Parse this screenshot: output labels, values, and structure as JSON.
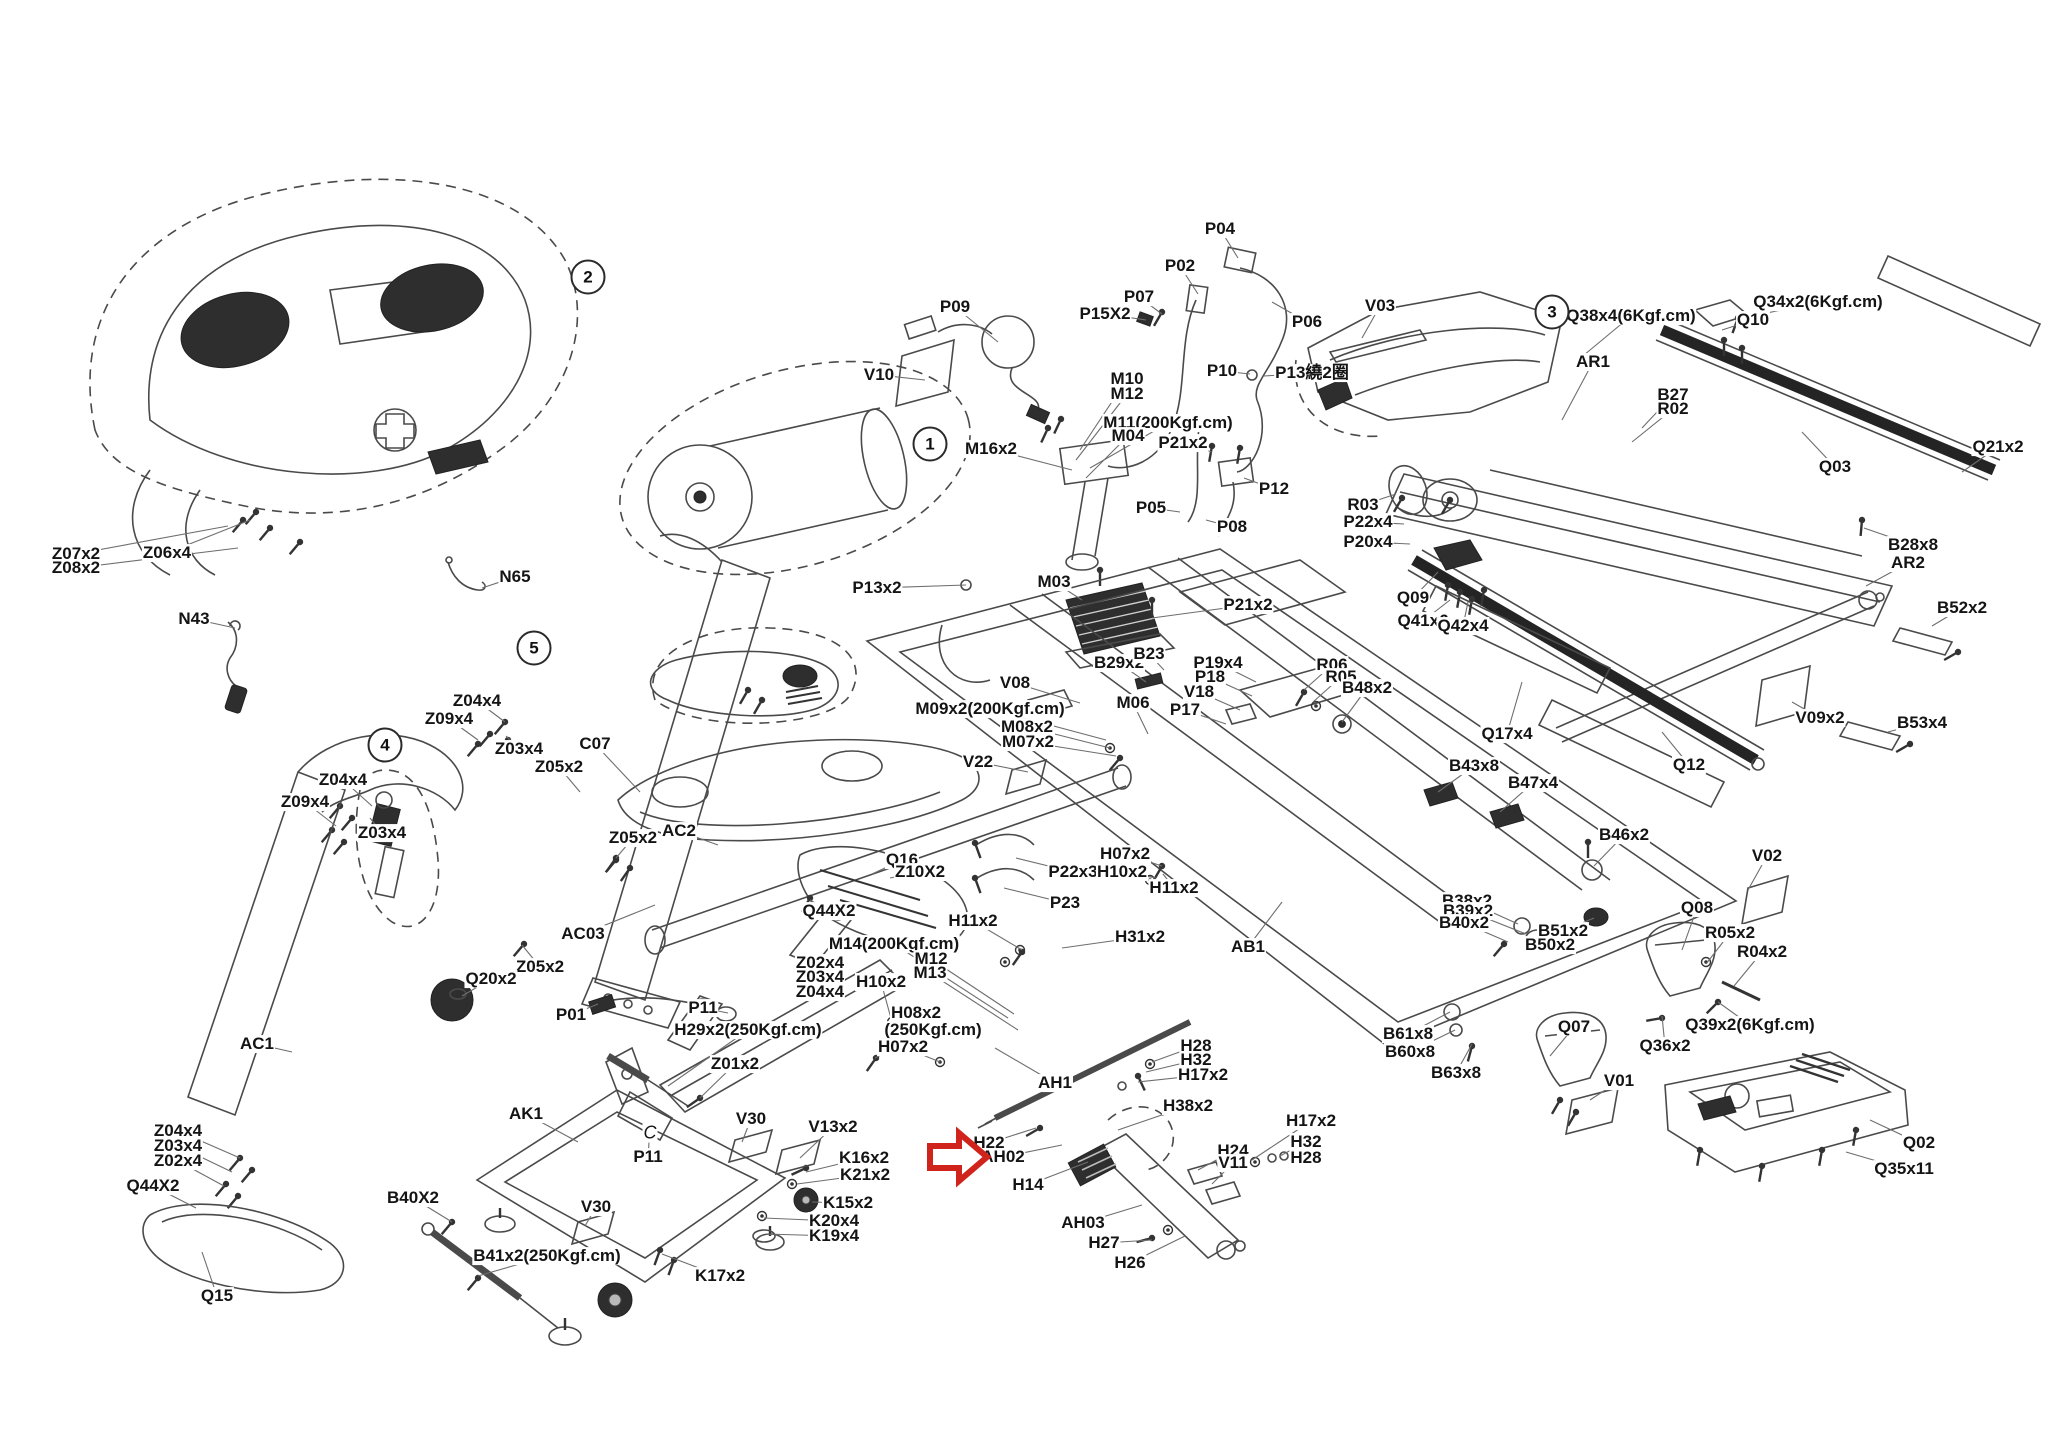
{
  "diagram": {
    "type": "exploded-parts-diagram",
    "subject": "treadmill assembly",
    "accent_color": "#cf231c",
    "callouts": [
      {
        "num": "1",
        "x": 930,
        "y": 444
      },
      {
        "num": "2",
        "x": 588,
        "y": 277
      },
      {
        "num": "3",
        "x": 1552,
        "y": 312
      },
      {
        "num": "4",
        "x": 385,
        "y": 745
      },
      {
        "num": "5",
        "x": 534,
        "y": 648
      }
    ],
    "arrow": {
      "x": 938,
      "y": 1138,
      "points_to": "AH02",
      "color": "#cf231c"
    },
    "labels": [
      {
        "t": "Z07x2",
        "x": 76,
        "y": 554,
        "tx": 228,
        "ty": 526
      },
      {
        "t": "Z08x2",
        "x": 76,
        "y": 568,
        "tx": 238,
        "ty": 548
      },
      {
        "t": "Z06x4",
        "x": 167,
        "y": 553,
        "tx": 250,
        "ty": 520
      },
      {
        "t": "N43",
        "x": 194,
        "y": 619,
        "tx": 235,
        "ty": 628
      },
      {
        "t": "N65",
        "x": 515,
        "y": 577,
        "tx": 482,
        "ty": 588
      },
      {
        "t": "Z04x4",
        "x": 477,
        "y": 701,
        "tx": 505,
        "ty": 722
      },
      {
        "t": "Z09x4",
        "x": 449,
        "y": 719,
        "tx": 478,
        "ty": 740
      },
      {
        "t": "Z03x4",
        "x": 519,
        "y": 749,
        "tx": 506,
        "ty": 736
      },
      {
        "t": "C07",
        "x": 595,
        "y": 744,
        "tx": 640,
        "ty": 792
      },
      {
        "t": "Z05x2",
        "x": 559,
        "y": 767,
        "tx": 580,
        "ty": 792
      },
      {
        "t": "Z04x4",
        "x": 343,
        "y": 780,
        "tx": 372,
        "ty": 806
      },
      {
        "t": "Z09x4",
        "x": 305,
        "y": 802,
        "tx": 336,
        "ty": 826
      },
      {
        "t": "Z03x4",
        "x": 382,
        "y": 833,
        "tx": 370,
        "ty": 818
      },
      {
        "t": "AC2",
        "x": 679,
        "y": 831,
        "tx": 718,
        "ty": 845
      },
      {
        "t": "Z05x2",
        "x": 633,
        "y": 838,
        "tx": 616,
        "ty": 858
      },
      {
        "t": "AC03",
        "x": 583,
        "y": 934,
        "tx": 655,
        "ty": 905
      },
      {
        "t": "Z05x2",
        "x": 540,
        "y": 967,
        "tx": 522,
        "ty": 945
      },
      {
        "t": "Q20x2",
        "x": 491,
        "y": 979,
        "tx": 462,
        "ty": 996
      },
      {
        "t": "P01",
        "x": 571,
        "y": 1015,
        "tx": 598,
        "ty": 1004
      },
      {
        "t": "P11",
        "x": 703,
        "y": 1008,
        "tx": 728,
        "ty": 1013
      },
      {
        "t": "H29x2(250Kgf.cm)",
        "x": 748,
        "y": 1030,
        "tx": 668,
        "ty": 1086
      },
      {
        "t": "Z01x2",
        "x": 735,
        "y": 1064,
        "tx": 700,
        "ty": 1098
      },
      {
        "t": "AK1",
        "x": 526,
        "y": 1114,
        "tx": 578,
        "ty": 1142
      },
      {
        "t": "AC1",
        "x": 257,
        "y": 1044,
        "tx": 292,
        "ty": 1052
      },
      {
        "t": "Z04x4",
        "x": 178,
        "y": 1131,
        "tx": 240,
        "ty": 1158
      },
      {
        "t": "Z03x4",
        "x": 178,
        "y": 1146,
        "tx": 232,
        "ty": 1172
      },
      {
        "t": "Z02x4",
        "x": 178,
        "y": 1161,
        "tx": 224,
        "ty": 1186
      },
      {
        "t": "Q44X2",
        "x": 153,
        "y": 1186,
        "tx": 196,
        "ty": 1208
      },
      {
        "t": "Q15",
        "x": 217,
        "y": 1296,
        "tx": 202,
        "ty": 1252
      },
      {
        "t": "B40X2",
        "x": 413,
        "y": 1198,
        "tx": 452,
        "ty": 1222
      },
      {
        "t": "B41x2(250Kgf.cm)",
        "x": 547,
        "y": 1256,
        "tx": 478,
        "ty": 1276
      },
      {
        "t": "P11",
        "x": 648,
        "y": 1157,
        "tx": 650,
        "ty": 1128
      },
      {
        "t": "C",
        "x": 650,
        "y": 1133,
        "cls": "italic"
      },
      {
        "t": "V30",
        "x": 751,
        "y": 1119,
        "tx": 742,
        "ty": 1142
      },
      {
        "t": "V13x2",
        "x": 833,
        "y": 1127,
        "tx": 800,
        "ty": 1158
      },
      {
        "t": "K16x2",
        "x": 864,
        "y": 1158,
        "tx": 806,
        "ty": 1172
      },
      {
        "t": "K21x2",
        "x": 865,
        "y": 1175,
        "tx": 797,
        "ty": 1184
      },
      {
        "t": "K15x2",
        "x": 848,
        "y": 1203,
        "tx": 812,
        "ty": 1202
      },
      {
        "t": "K20x4",
        "x": 834,
        "y": 1221,
        "tx": 764,
        "ty": 1218
      },
      {
        "t": "K19x4",
        "x": 834,
        "y": 1236,
        "tx": 766,
        "ty": 1234
      },
      {
        "t": "K17x2",
        "x": 720,
        "y": 1276,
        "tx": 662,
        "ty": 1254
      },
      {
        "t": "V30",
        "x": 596,
        "y": 1207,
        "tx": 585,
        "ty": 1226
      },
      {
        "t": "Q16",
        "x": 902,
        "y": 860,
        "tx": 872,
        "ty": 874
      },
      {
        "t": "Z10X2",
        "x": 920,
        "y": 872,
        "tx": 890,
        "ty": 878
      },
      {
        "t": "Q44X2",
        "x": 829,
        "y": 911,
        "tx": 810,
        "ty": 900
      },
      {
        "t": "M14(200Kgf.cm)",
        "x": 894,
        "y": 944,
        "tx": 1008,
        "ty": 1018
      },
      {
        "t": "M12",
        "x": 931,
        "y": 959,
        "tx": 1014,
        "ty": 1014
      },
      {
        "t": "M13",
        "x": 930,
        "y": 973,
        "tx": 1018,
        "ty": 1030
      },
      {
        "t": "Z02x4",
        "x": 820,
        "y": 963
      },
      {
        "t": "Z03x4",
        "x": 820,
        "y": 977
      },
      {
        "t": "Z04x4",
        "x": 820,
        "y": 992
      },
      {
        "t": "H10x2",
        "x": 881,
        "y": 982,
        "tx": 892,
        "ty": 1022
      },
      {
        "t": "H08x2",
        "x": 916,
        "y": 1013
      },
      {
        "t": "(250Kgf.cm)",
        "x": 933,
        "y": 1030,
        "tx": 875,
        "ty": 1058
      },
      {
        "t": "H07x2",
        "x": 903,
        "y": 1047,
        "tx": 940,
        "ty": 1062
      },
      {
        "t": "AH1",
        "x": 1055,
        "y": 1083,
        "tx": 995,
        "ty": 1048
      },
      {
        "t": "H11x2",
        "x": 973,
        "y": 921,
        "tx": 1022,
        "ty": 950
      },
      {
        "t": "H31x2",
        "x": 1140,
        "y": 937,
        "tx": 1062,
        "ty": 948
      },
      {
        "t": "AB1",
        "x": 1248,
        "y": 947,
        "tx": 1282,
        "ty": 902
      },
      {
        "t": "P22x3",
        "x": 1073,
        "y": 872,
        "tx": 1016,
        "ty": 858
      },
      {
        "t": "P23",
        "x": 1065,
        "y": 903,
        "tx": 1004,
        "ty": 888
      },
      {
        "t": "H07x2",
        "x": 1125,
        "y": 854,
        "tx": 1162,
        "ty": 866
      },
      {
        "t": "H10x2",
        "x": 1122,
        "y": 872,
        "tx": 1156,
        "ty": 878
      },
      {
        "t": "H11x2",
        "x": 1174,
        "y": 888,
        "tx": 1163,
        "ty": 874
      },
      {
        "t": "H28",
        "x": 1196,
        "y": 1046,
        "tx": 1152,
        "ty": 1062
      },
      {
        "t": "H32",
        "x": 1196,
        "y": 1060,
        "tx": 1146,
        "ty": 1072
      },
      {
        "t": "H17x2",
        "x": 1203,
        "y": 1075,
        "tx": 1138,
        "ty": 1082
      },
      {
        "t": "H38x2",
        "x": 1188,
        "y": 1106,
        "tx": 1118,
        "ty": 1130
      },
      {
        "t": "H22",
        "x": 989,
        "y": 1143,
        "tx": 1036,
        "ty": 1128
      },
      {
        "t": "AH02",
        "x": 1003,
        "y": 1157,
        "tx": 1062,
        "ty": 1145
      },
      {
        "t": "H14",
        "x": 1028,
        "y": 1185,
        "tx": 1088,
        "ty": 1162
      },
      {
        "t": "AH03",
        "x": 1083,
        "y": 1223,
        "tx": 1142,
        "ty": 1205
      },
      {
        "t": "H27",
        "x": 1104,
        "y": 1243,
        "tx": 1152,
        "ty": 1240
      },
      {
        "t": "H26",
        "x": 1130,
        "y": 1263,
        "tx": 1185,
        "ty": 1236
      },
      {
        "t": "H24",
        "x": 1233,
        "y": 1151,
        "tx": 1198,
        "ty": 1170
      },
      {
        "t": "V11",
        "x": 1233,
        "y": 1163,
        "tx": 1212,
        "ty": 1184
      },
      {
        "t": "H17x2",
        "x": 1311,
        "y": 1121,
        "tx": 1252,
        "ty": 1160
      },
      {
        "t": "H32",
        "x": 1306,
        "y": 1142,
        "tx": 1280,
        "ty": 1156
      },
      {
        "t": "H28",
        "x": 1306,
        "y": 1158,
        "tx": 1292,
        "ty": 1160
      },
      {
        "t": "P09",
        "x": 955,
        "y": 307,
        "tx": 998,
        "ty": 342
      },
      {
        "t": "V10",
        "x": 879,
        "y": 375,
        "tx": 925,
        "ty": 380
      },
      {
        "t": "M16x2",
        "x": 991,
        "y": 449,
        "tx": 1072,
        "ty": 470
      },
      {
        "t": "P04",
        "x": 1220,
        "y": 229,
        "tx": 1238,
        "ty": 258
      },
      {
        "t": "P02",
        "x": 1180,
        "y": 266,
        "tx": 1198,
        "ty": 294
      },
      {
        "t": "P07",
        "x": 1139,
        "y": 297,
        "tx": 1162,
        "ty": 314
      },
      {
        "t": "P15X2",
        "x": 1105,
        "y": 314,
        "tx": 1146,
        "ty": 320
      },
      {
        "t": "P06",
        "x": 1307,
        "y": 322,
        "tx": 1272,
        "ty": 302
      },
      {
        "t": "V03",
        "x": 1380,
        "y": 306,
        "tx": 1362,
        "ty": 338
      },
      {
        "t": "P10",
        "x": 1222,
        "y": 371,
        "tx": 1250,
        "ty": 374
      },
      {
        "t": "P13繞2圈",
        "x": 1312,
        "y": 373,
        "tx": 1264,
        "ty": 376
      },
      {
        "t": "M10",
        "x": 1127,
        "y": 379,
        "tx": 1080,
        "ty": 450
      },
      {
        "t": "M12",
        "x": 1127,
        "y": 394,
        "tx": 1076,
        "ty": 460
      },
      {
        "t": "M11(200Kgf.cm)",
        "x": 1168,
        "y": 423,
        "tx": 1090,
        "ty": 468
      },
      {
        "t": "M04",
        "x": 1128,
        "y": 436,
        "tx": 1086,
        "ty": 478
      },
      {
        "t": "P21x2",
        "x": 1183,
        "y": 443,
        "tx": 1212,
        "ty": 452
      },
      {
        "t": "P12",
        "x": 1274,
        "y": 489,
        "tx": 1244,
        "ty": 478
      },
      {
        "t": "P05",
        "x": 1151,
        "y": 508,
        "tx": 1180,
        "ty": 512
      },
      {
        "t": "P08",
        "x": 1232,
        "y": 527,
        "tx": 1206,
        "ty": 520
      },
      {
        "t": "P13x2",
        "x": 877,
        "y": 588,
        "tx": 966,
        "ty": 585
      },
      {
        "t": "M03",
        "x": 1054,
        "y": 582,
        "tx": 1082,
        "ty": 600
      },
      {
        "t": "P21x2",
        "x": 1248,
        "y": 605,
        "tx": 1152,
        "ty": 618
      },
      {
        "t": "B29x2",
        "x": 1119,
        "y": 663,
        "tx": 1146,
        "ty": 682
      },
      {
        "t": "B23",
        "x": 1149,
        "y": 654,
        "tx": 1164,
        "ty": 670
      },
      {
        "t": "P19x4",
        "x": 1218,
        "y": 663,
        "tx": 1256,
        "ty": 682
      },
      {
        "t": "P18",
        "x": 1210,
        "y": 677,
        "tx": 1252,
        "ty": 696
      },
      {
        "t": "V18",
        "x": 1199,
        "y": 692,
        "tx": 1240,
        "ty": 710
      },
      {
        "t": "P17",
        "x": 1185,
        "y": 710,
        "tx": 1226,
        "ty": 724
      },
      {
        "t": "V08",
        "x": 1015,
        "y": 683,
        "tx": 1080,
        "ty": 703
      },
      {
        "t": "M09x2(200Kgf.cm)",
        "x": 990,
        "y": 709,
        "tx": 1106,
        "ty": 740
      },
      {
        "t": "M06",
        "x": 1133,
        "y": 703,
        "tx": 1148,
        "ty": 734
      },
      {
        "t": "M08x2",
        "x": 1027,
        "y": 727,
        "tx": 1110,
        "ty": 748
      },
      {
        "t": "M07x2",
        "x": 1028,
        "y": 742,
        "tx": 1116,
        "ty": 756
      },
      {
        "t": "V22",
        "x": 978,
        "y": 762,
        "tx": 1028,
        "ty": 772
      },
      {
        "t": "R06",
        "x": 1332,
        "y": 665,
        "tx": 1304,
        "ty": 690
      },
      {
        "t": "R05",
        "x": 1341,
        "y": 677,
        "tx": 1313,
        "ty": 702
      },
      {
        "t": "B48x2",
        "x": 1367,
        "y": 688,
        "tx": 1342,
        "ty": 722
      },
      {
        "t": "Q38x4(6Kgf.cm)",
        "x": 1631,
        "y": 316,
        "tx": 1578,
        "ty": 360
      },
      {
        "t": "AR1",
        "x": 1593,
        "y": 362,
        "tx": 1562,
        "ty": 420
      },
      {
        "t": "Q34x2(6Kgf.cm)",
        "x": 1818,
        "y": 302,
        "tx": 1744,
        "ty": 318
      },
      {
        "t": "Q10",
        "x": 1753,
        "y": 320,
        "tx": 1722,
        "ty": 330
      },
      {
        "t": "B27",
        "x": 1673,
        "y": 395,
        "tx": 1642,
        "ty": 428
      },
      {
        "t": "R02",
        "x": 1673,
        "y": 409,
        "tx": 1632,
        "ty": 442
      },
      {
        "t": "Q03",
        "x": 1835,
        "y": 467,
        "tx": 1802,
        "ty": 432
      },
      {
        "t": "Q21x2",
        "x": 1998,
        "y": 447,
        "tx": 1962,
        "ty": 472
      },
      {
        "t": "B28x8",
        "x": 1913,
        "y": 545,
        "tx": 1864,
        "ty": 528
      },
      {
        "t": "AR2",
        "x": 1908,
        "y": 563,
        "tx": 1866,
        "ty": 586
      },
      {
        "t": "B52x2",
        "x": 1962,
        "y": 608,
        "tx": 1932,
        "ty": 626
      },
      {
        "t": "R03",
        "x": 1363,
        "y": 505,
        "tx": 1396,
        "ty": 494
      },
      {
        "t": "P22x4",
        "x": 1368,
        "y": 522,
        "tx": 1404,
        "ty": 524
      },
      {
        "t": "P20x4",
        "x": 1368,
        "y": 542,
        "tx": 1410,
        "ty": 544
      },
      {
        "t": "Q09",
        "x": 1413,
        "y": 598,
        "tx": 1438,
        "ty": 572
      },
      {
        "t": "Q41x6",
        "x": 1423,
        "y": 621,
        "tx": 1450,
        "ty": 600
      },
      {
        "t": "Q42x4",
        "x": 1463,
        "y": 626,
        "tx": 1468,
        "ty": 602
      },
      {
        "t": "Q17x4",
        "x": 1507,
        "y": 734,
        "tx": 1522,
        "ty": 682
      },
      {
        "t": "Q12",
        "x": 1689,
        "y": 765,
        "tx": 1662,
        "ty": 732
      },
      {
        "t": "B43x8",
        "x": 1474,
        "y": 766,
        "tx": 1438,
        "ty": 792
      },
      {
        "t": "B47x4",
        "x": 1533,
        "y": 783,
        "tx": 1500,
        "ty": 812
      },
      {
        "t": "V09x2",
        "x": 1820,
        "y": 718,
        "tx": 1792,
        "ty": 702
      },
      {
        "t": "B53x4",
        "x": 1922,
        "y": 723,
        "tx": 1888,
        "ty": 732
      },
      {
        "t": "B46x2",
        "x": 1624,
        "y": 835,
        "tx": 1594,
        "ty": 866
      },
      {
        "t": "V02",
        "x": 1767,
        "y": 856,
        "tx": 1748,
        "ty": 890
      },
      {
        "t": "Q08",
        "x": 1697,
        "y": 908,
        "tx": 1682,
        "ty": 950
      },
      {
        "t": "R05x2",
        "x": 1730,
        "y": 933,
        "tx": 1706,
        "ty": 964
      },
      {
        "t": "R04x2",
        "x": 1762,
        "y": 952,
        "tx": 1734,
        "ty": 986
      },
      {
        "t": "Q39x2(6Kgf.cm)",
        "x": 1750,
        "y": 1025,
        "tx": 1718,
        "ty": 1002
      },
      {
        "t": "Q36x2",
        "x": 1665,
        "y": 1046,
        "tx": 1662,
        "ty": 1016
      },
      {
        "t": "B38x2",
        "x": 1467,
        "y": 901,
        "tx": 1518,
        "ty": 924
      },
      {
        "t": "B39x2",
        "x": 1468,
        "y": 911,
        "tx": 1526,
        "ty": 934
      },
      {
        "t": "B40x2",
        "x": 1464,
        "y": 923,
        "tx": 1508,
        "ty": 942
      },
      {
        "t": "B51x2",
        "x": 1563,
        "y": 931,
        "tx": 1594,
        "ty": 918
      },
      {
        "t": "B50x2",
        "x": 1550,
        "y": 945,
        "tx": 1588,
        "ty": 932
      },
      {
        "t": "B61x8",
        "x": 1408,
        "y": 1034,
        "tx": 1450,
        "ty": 1012
      },
      {
        "t": "B60x8",
        "x": 1410,
        "y": 1052,
        "tx": 1455,
        "ty": 1030
      },
      {
        "t": "B63x8",
        "x": 1456,
        "y": 1073,
        "tx": 1472,
        "ty": 1044
      },
      {
        "t": "Q07",
        "x": 1574,
        "y": 1027,
        "tx": 1550,
        "ty": 1056
      },
      {
        "t": "V01",
        "x": 1619,
        "y": 1081,
        "tx": 1590,
        "ty": 1100
      },
      {
        "t": "Q02",
        "x": 1919,
        "y": 1143,
        "tx": 1870,
        "ty": 1120
      },
      {
        "t": "Q35x11",
        "x": 1904,
        "y": 1169,
        "tx": 1846,
        "ty": 1152
      }
    ]
  }
}
